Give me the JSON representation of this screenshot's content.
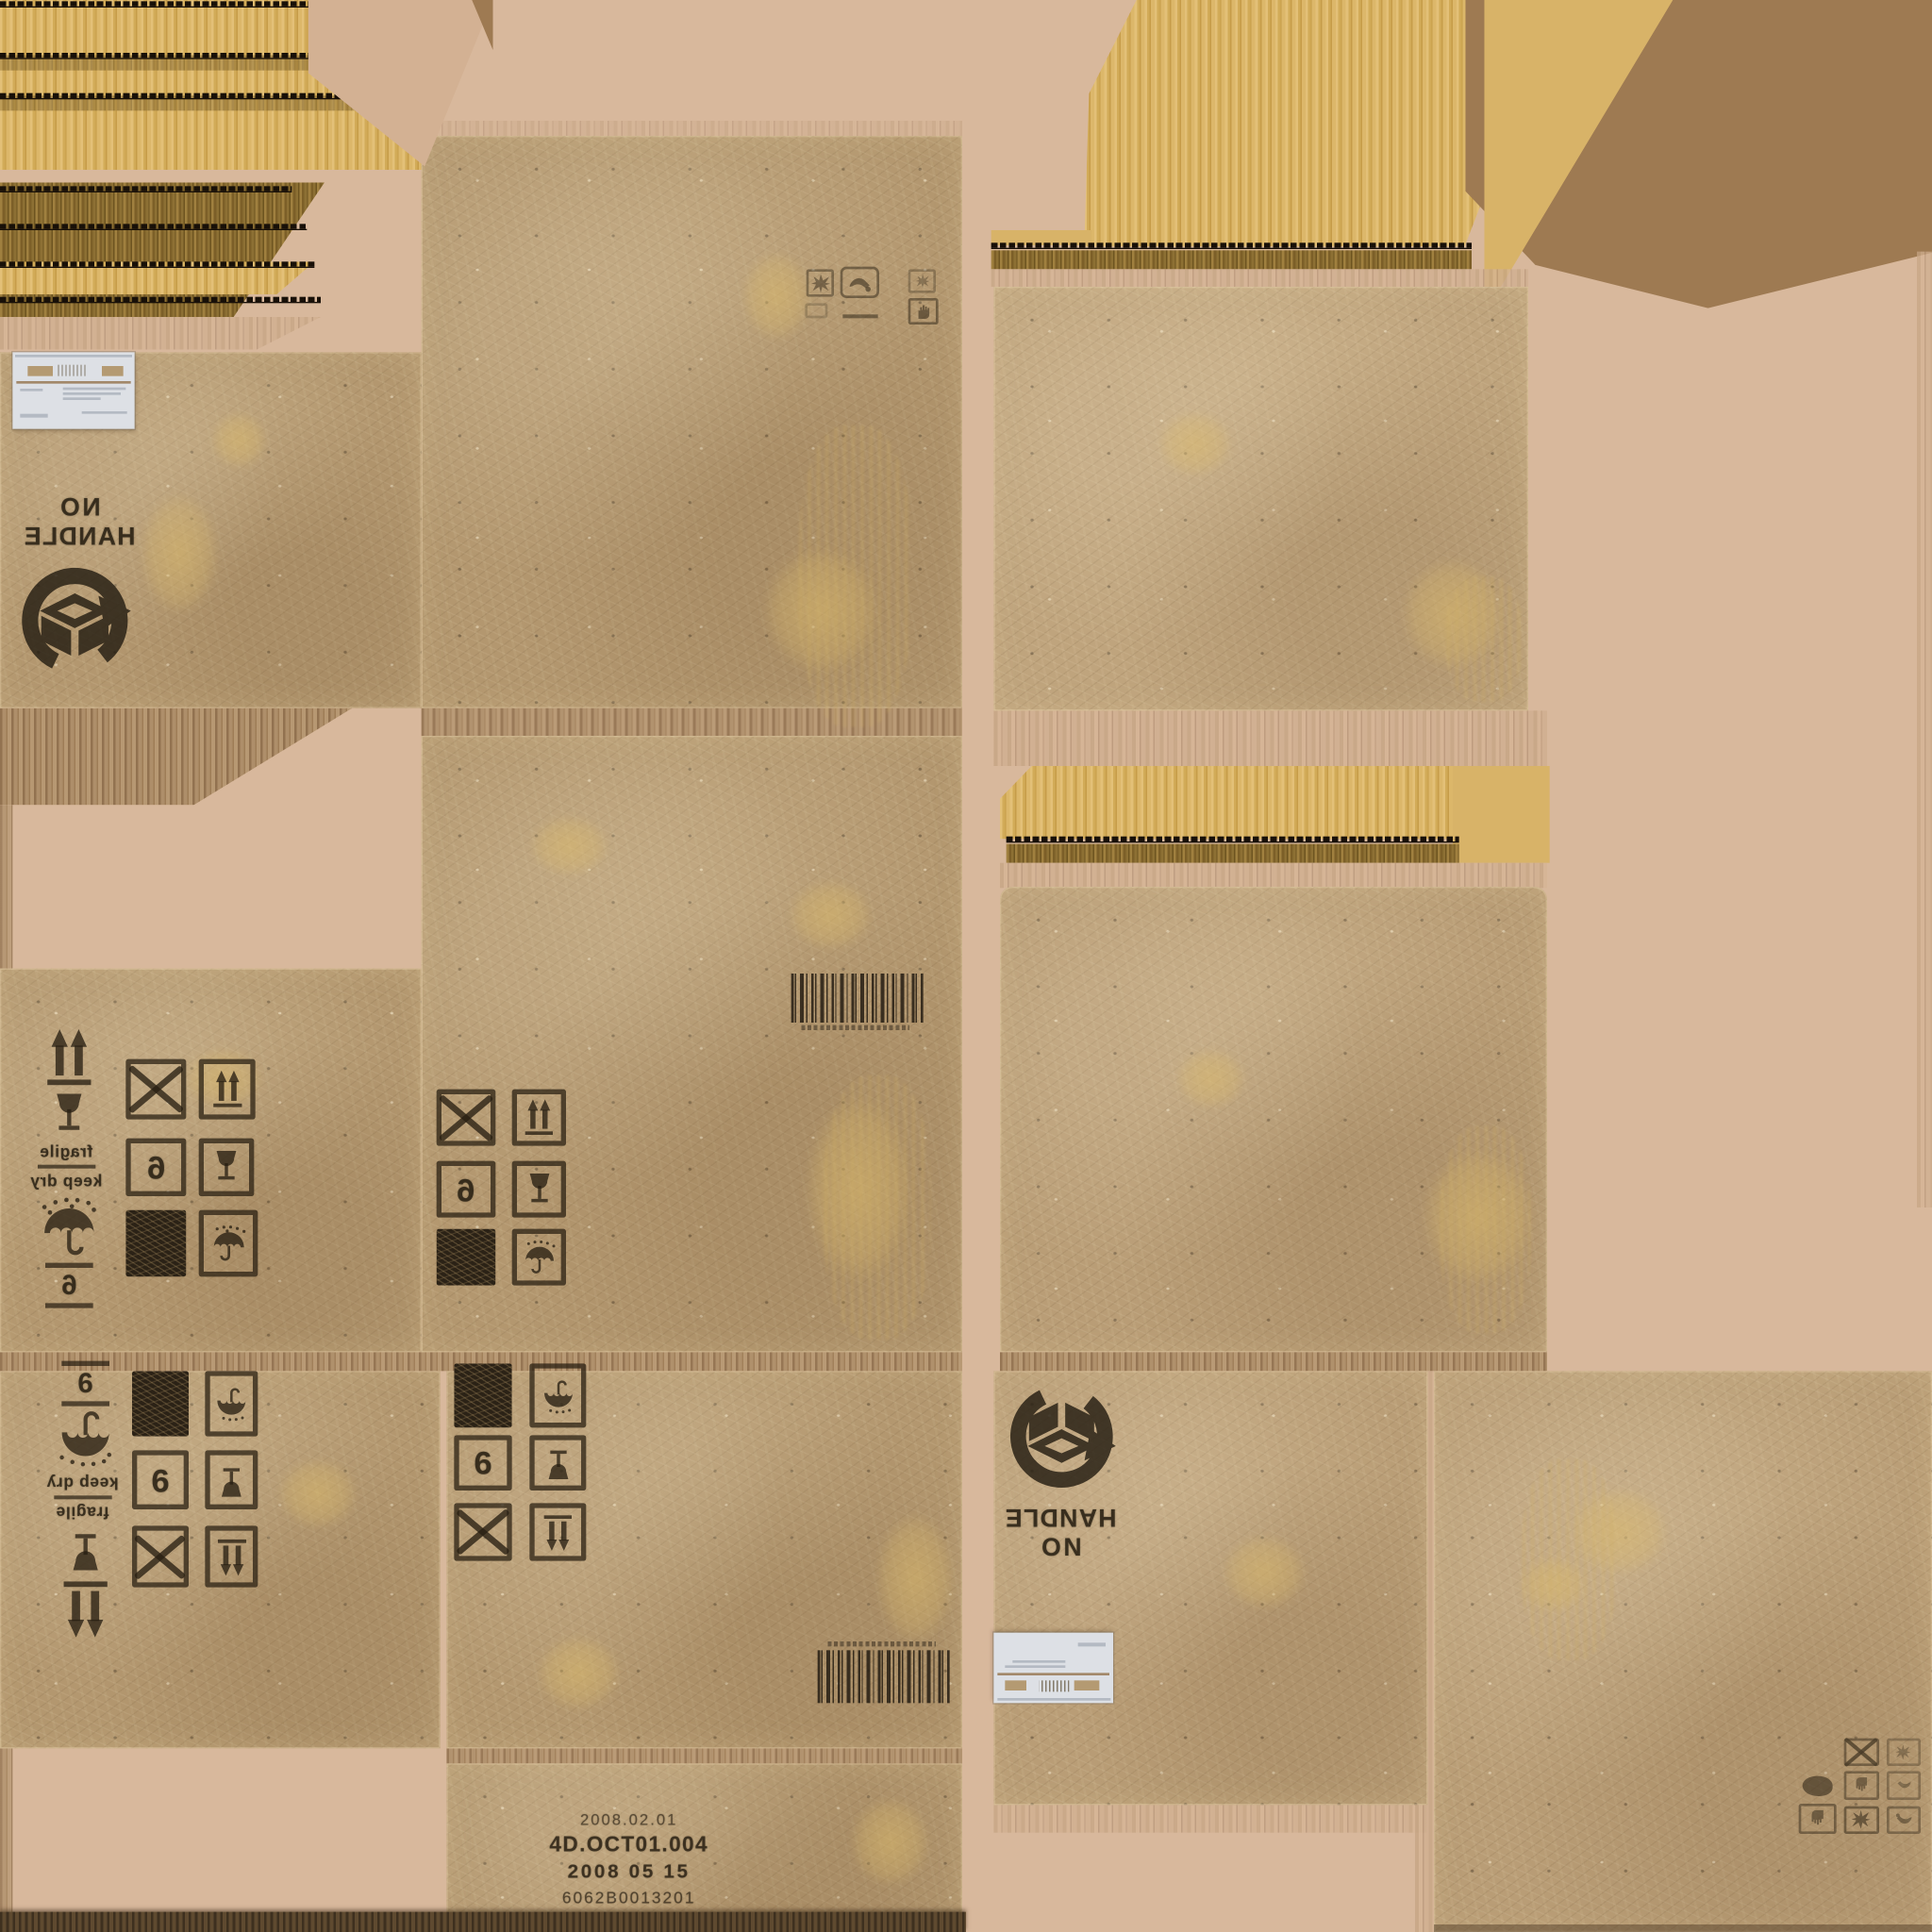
{
  "texture": {
    "type": "cardboard shipping box texture atlas",
    "colors": {
      "cardboard": "#b3976f",
      "cardboard_light": "#bfa47d",
      "gold_corrugation": "#d9b366",
      "gold_dark": "#7c5f28",
      "background_pink": "#d8b89c",
      "flat_brown": "#9e7a52",
      "stamp_ink": "#2a2114",
      "label_white": "#dde0e5"
    }
  },
  "stamps": {
    "no_handle": {
      "line1": "NO",
      "line2": "HANDLE"
    },
    "fragile": "fragile",
    "keep_dry": "keep dry",
    "digit_column_left": "6",
    "digit_column_bottom": "6",
    "digit_grid_mid_left": "6",
    "digit_grid_mid_center": "6",
    "digit_grid_bottom_left": "6",
    "digit_grid_bottom_center": "6"
  },
  "production": {
    "line1": "2008.02.01",
    "line2": "4D.OCT01.004",
    "line3": "2008 05 15",
    "line4": "6062B0013201"
  },
  "icons": {
    "this-way-up": "two up arrows over baseline",
    "fragile-glass": "wine glass",
    "keep-dry-umbrella": "umbrella with raindrops",
    "do-not-clamp": "crossed-out square",
    "solid-square": "filled black square",
    "recycle-box-stamp": "circular arrow around open carton",
    "barcode": "vertical bar code",
    "shipping-label": "white shipping label with barcode",
    "starburst": "impact burst",
    "hand": "hand symbol",
    "clamp": "clamp squiggle"
  }
}
